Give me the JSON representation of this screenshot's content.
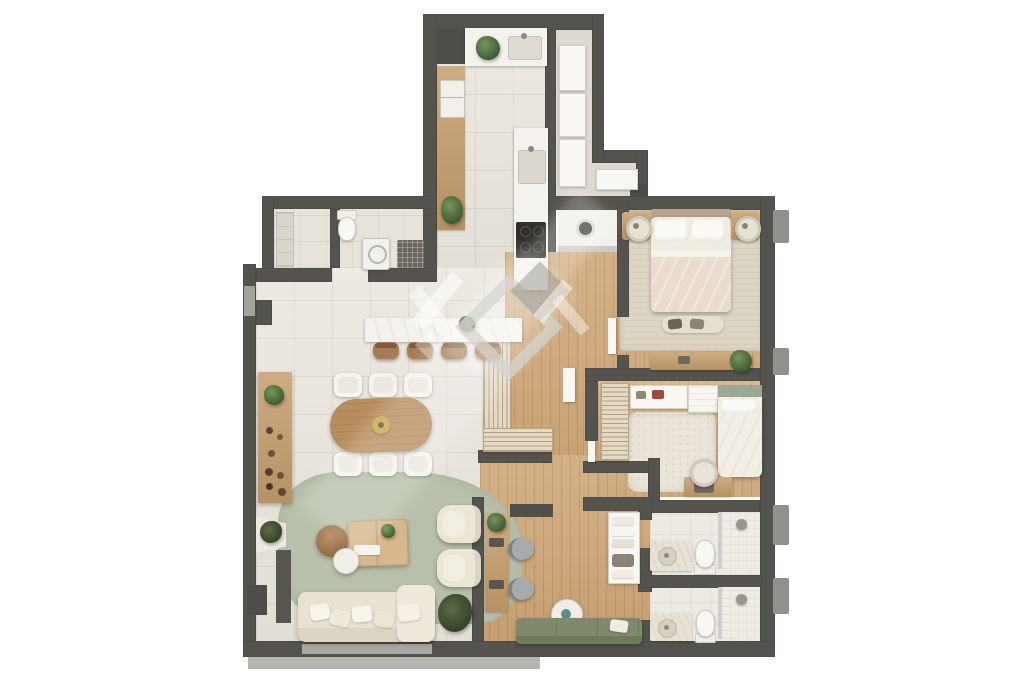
{
  "title": "apartment-floor-plan-top-view",
  "canvas": {
    "width": 1024,
    "height": 683,
    "background": "#ffffff"
  },
  "palette": {
    "wall": "#54534e",
    "tile_floor": "#e9e5dc",
    "wood_floor": "#cfa878",
    "wood_floor_light": "#d6b083",
    "counter_marble": "#f4f2ec",
    "cabinet_wood": "#c59e6c",
    "rug_living_green": "#b8bfaa",
    "rug_master_beige": "#dcd5c3",
    "rug_bedroom_cream": "#eae5d8",
    "sofa_cream": "#e9e2d2",
    "sofa_green": "#7f8a6c",
    "plant_green": "#4d6b3c",
    "cooktop_black": "#2f2e2b",
    "balcony_concrete": "#b6b6b0",
    "glass_gray": "#aaa9a4",
    "fixture_white": "#f8f7f3",
    "watermark_gray": "rgba(150,148,142,0.5)",
    "watermark_white": "rgba(255,255,255,0.5)"
  },
  "watermark": {
    "name": "developer-logo-watermark",
    "style": "diamond-monogram-glare"
  },
  "rooms": [
    {
      "name": "kitchen",
      "floor": "tile",
      "furniture": [
        "tall-cabinet",
        "sink-counter",
        "potted-plant",
        "refrigerator",
        "wood-cabinets",
        "island-counter",
        "island-sink",
        "cooktop"
      ]
    },
    {
      "name": "entry-closet",
      "floor": "tile",
      "furniture": [
        "wardrobe-panels"
      ]
    },
    {
      "name": "guest-wc",
      "floor": "stone",
      "furniture": [
        "round-basin"
      ]
    },
    {
      "name": "laundry",
      "floor": "tile",
      "furniture": [
        "shelving-unit",
        "toilet",
        "washing-machine",
        "utility-rack"
      ]
    },
    {
      "name": "master-bedroom",
      "floor": "wood",
      "furniture": [
        "double-bed",
        "pillows",
        "nightstand-left",
        "nightstand-right",
        "lamps",
        "area-rug",
        "foot-bench",
        "dresser",
        "plant"
      ]
    },
    {
      "name": "second-bedroom",
      "floor": "wood",
      "furniture": [
        "slatted-wardrobe",
        "wall-shelf",
        "storage-cabinet",
        "single-bed",
        "fluffy-rug",
        "desk",
        "chair"
      ]
    },
    {
      "name": "hallway",
      "floor": "wood",
      "furniture": [
        "slatted-console",
        "white-door"
      ]
    },
    {
      "name": "bathroom-1",
      "floor": "tile",
      "furniture": [
        "vanity-sink",
        "toilet",
        "glass-shower"
      ]
    },
    {
      "name": "bathroom-2",
      "floor": "tile",
      "furniture": [
        "vanity-sink",
        "toilet",
        "glass-shower"
      ]
    },
    {
      "name": "home-office",
      "floor": "wood",
      "furniture": [
        "wall-desk",
        "monitors",
        "office-chairs",
        "plant",
        "round-side-table",
        "green-sofa",
        "linen-shelf"
      ]
    },
    {
      "name": "living-room",
      "floor": "tile",
      "furniture": [
        "sectional-sofa",
        "chaise",
        "throw-pillows",
        "armchair-1",
        "armchair-2",
        "coffee-table",
        "pouf",
        "side-table",
        "green-area-rug",
        "tv-panel",
        "corner-console",
        "dry-plant",
        "floor-plant"
      ]
    },
    {
      "name": "dining-room",
      "floor": "tile",
      "furniture": [
        "oval-dining-table",
        "centerpiece",
        "six-white-chairs",
        "sideboard",
        "decor-bottles",
        "bar-counter",
        "bar-plant",
        "four-bar-stools"
      ]
    },
    {
      "name": "balcony",
      "floor": "concrete",
      "furniture": []
    }
  ],
  "exterior": {
    "features": [
      "right-facade-pillars",
      "left-window",
      "balcony-slab",
      "chimney-stub"
    ]
  }
}
